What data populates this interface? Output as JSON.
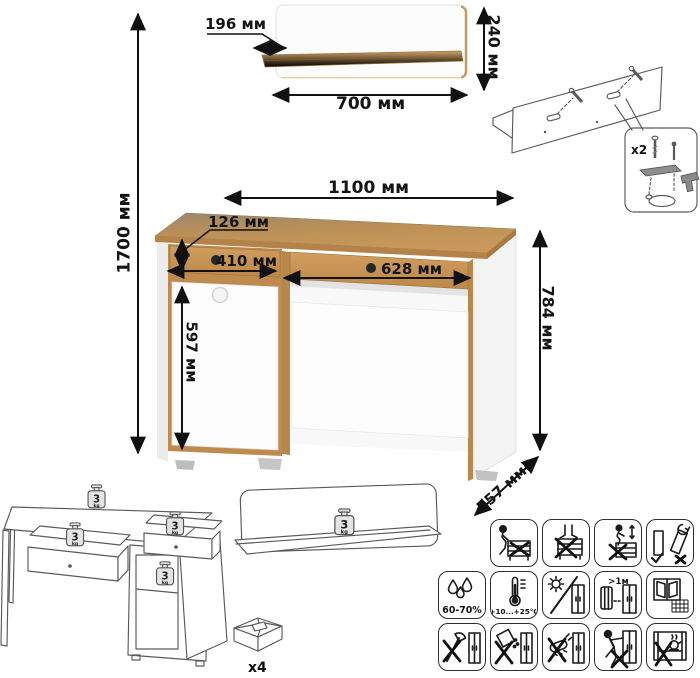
{
  "title": "desk-with-wall-shelf-dimension-diagram",
  "units": "мм",
  "dims": {
    "total_height": "1700 мм",
    "shelf_depth": "196 мм",
    "shelf_height": "240 мм",
    "shelf_width": "700 мм",
    "desk_width": "1100 мм",
    "drawer_height": "126 мм",
    "left_drawer_width": "410 мм",
    "right_drawer_width": "628 мм",
    "door_height": "597 мм",
    "desk_height": "784 мм",
    "desk_depth": "557 мм"
  },
  "hardware": {
    "wall_fitting_count": "x2",
    "feet_count": "x4"
  },
  "load": {
    "value": "3",
    "unit": "kg"
  },
  "care": {
    "humidity": "60-70%",
    "temperature": "+10...+25°C",
    "heat_distance": ">1м"
  },
  "icons": [
    "no-sitting-icon",
    "no-standing-icon",
    "no-climbing-icon",
    "carry-upright-icon",
    "humidity-icon",
    "temperature-icon",
    "no-direct-sunlight-icon",
    "heat-distance-icon",
    "ventilation-icon",
    "no-sharp-tools-icon",
    "no-spill-liquids-icon",
    "no-abrasive-icon",
    "no-dragging-icon",
    "no-hot-items-icon"
  ],
  "colors": {
    "wood": "#c28e52",
    "wood_dark": "#a87c3f",
    "panel_white": "#fbfbfb",
    "outline_gray": "#5a5a5a",
    "text": "#141414"
  }
}
